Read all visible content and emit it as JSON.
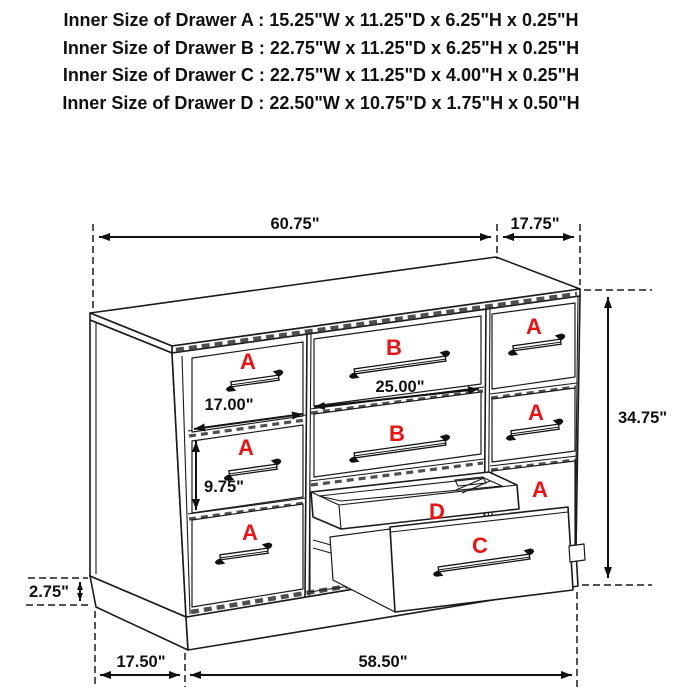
{
  "header": {
    "line1": "Inner Size of Drawer A : 15.25\"W x 11.25\"D x 6.25\"H x 0.25\"H",
    "line2": "Inner Size of Drawer B : 22.75\"W x 11.25\"D x 6.25\"H x 0.25\"H",
    "line3": "Inner Size of Drawer C : 22.75\"W x 11.25\"D x 4.00\"H x 0.25\"H",
    "line4": "Inner Size of Drawer  D : 22.50\"W x 10.75\"D x 1.75\"H x 0.50\"H"
  },
  "dimensions": {
    "top_width": "60.75\"",
    "top_depth": "17.75\"",
    "overall_height": "34.75\"",
    "drawer_a_front_width": "17.00\"",
    "drawer_b_front_width": "25.00\"",
    "drawer_a_front_height": "9.75\"",
    "base_height": "2.75\"",
    "base_side_depth": "17.50\"",
    "base_front_width": "58.50\""
  },
  "drawer_letters": {
    "a": "A",
    "b": "B",
    "c": "C",
    "d": "D"
  },
  "colors": {
    "line": "#1a1a1a",
    "label": "#ee1111"
  }
}
